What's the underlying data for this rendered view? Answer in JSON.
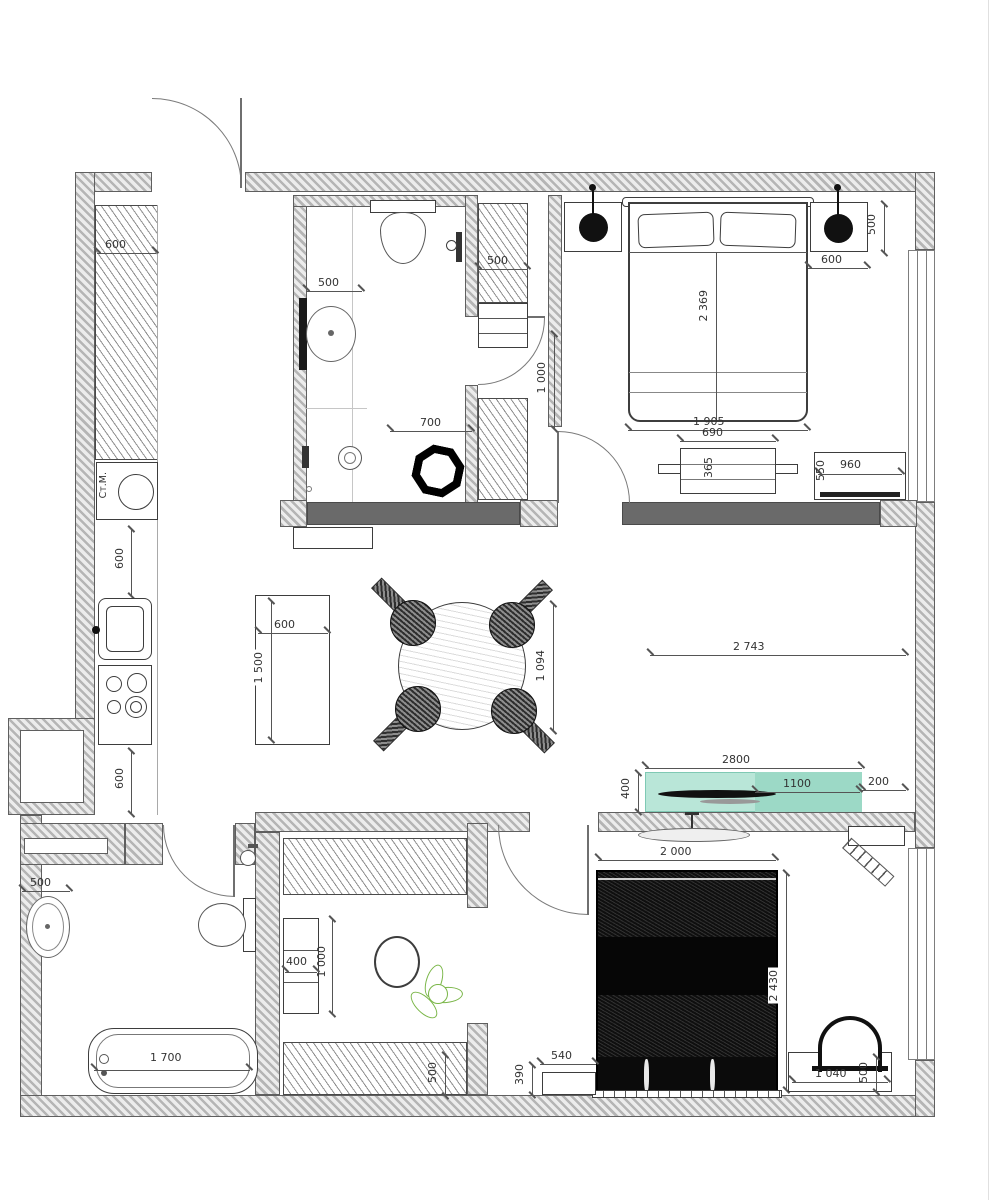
{
  "plan_type": "apartment-floor-plan",
  "colors": {
    "wall_hatch": "#b5b5b5",
    "wall_dark": "#6a6a6a",
    "furniture_dark": "#141414",
    "tv_zone_light": "#b9e6d8",
    "tv_zone_dark": "#9cd9c6",
    "tv_zone_border": "#7fc9b4",
    "plant_green": "#7ab648"
  },
  "labels": {
    "washing_machine": "Ст.М."
  },
  "dims": {
    "hall_wardrobe_width": "600",
    "kitchen_counter_upper": "600",
    "kitchen_counter_lower": "600",
    "island_width": "600",
    "island_length": "1 500",
    "table_diameter": "1 094",
    "bath1_sink": "500",
    "bath1_depth": "700",
    "corridor_wardrobe": "500",
    "corridor_opening": "1 000",
    "bed1_width": "1 905",
    "bed1_length": "2 369",
    "bed1_gap": "600",
    "bed1_side": "500",
    "bench_width": "690",
    "bench_depth": "365",
    "dresser_width": "960",
    "dresser_depth": "550",
    "sofa_width": "2 743",
    "tv_zone_width": "2800",
    "tv_zone_depth": "400",
    "tv_width": "1100",
    "tv_gap": "200",
    "bed2_width": "2 000",
    "bed2_length": "2 430",
    "nightstand2_width": "540",
    "nightstand2_depth": "390",
    "closet_shelf_width": "400",
    "closet_shelf_length": "1 000",
    "closet_wardrobe_depth": "500",
    "desk_width": "1 040",
    "desk_depth": "500",
    "bath2_sink": "500",
    "bathtub_length": "1 700"
  }
}
